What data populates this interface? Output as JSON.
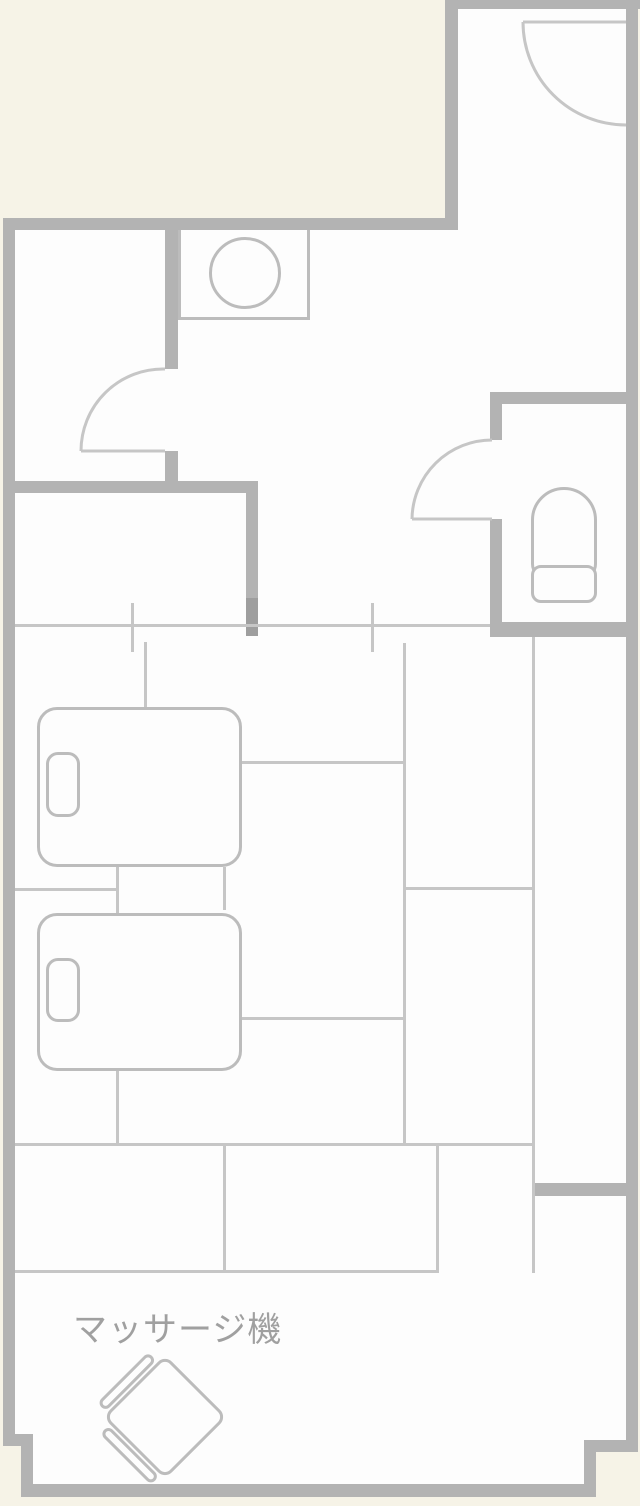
{
  "title": "hotel room floor plan",
  "labels": {
    "massage_chair": "マッサージ機"
  },
  "colors": {
    "background": "#f6f3e7",
    "interior": "#fdfdfd",
    "wall": "#b3b3b3",
    "wall_dark": "#9e9e9e",
    "line": "#c6c6c6",
    "fixture": "#bcbcbc",
    "text": "#a0a0a0"
  },
  "fixtures": {
    "entrance_door": "door-swing-arc",
    "bathroom_door": "door-swing-arc",
    "toilet_door": "door-swing-arc",
    "washbasin": "counter-with-round-bowl",
    "toilet": "toilet-bowl-with-tank",
    "beds": [
      "bed-with-pillow",
      "bed-with-pillow"
    ],
    "massage_chair": "rotated-armchair"
  }
}
